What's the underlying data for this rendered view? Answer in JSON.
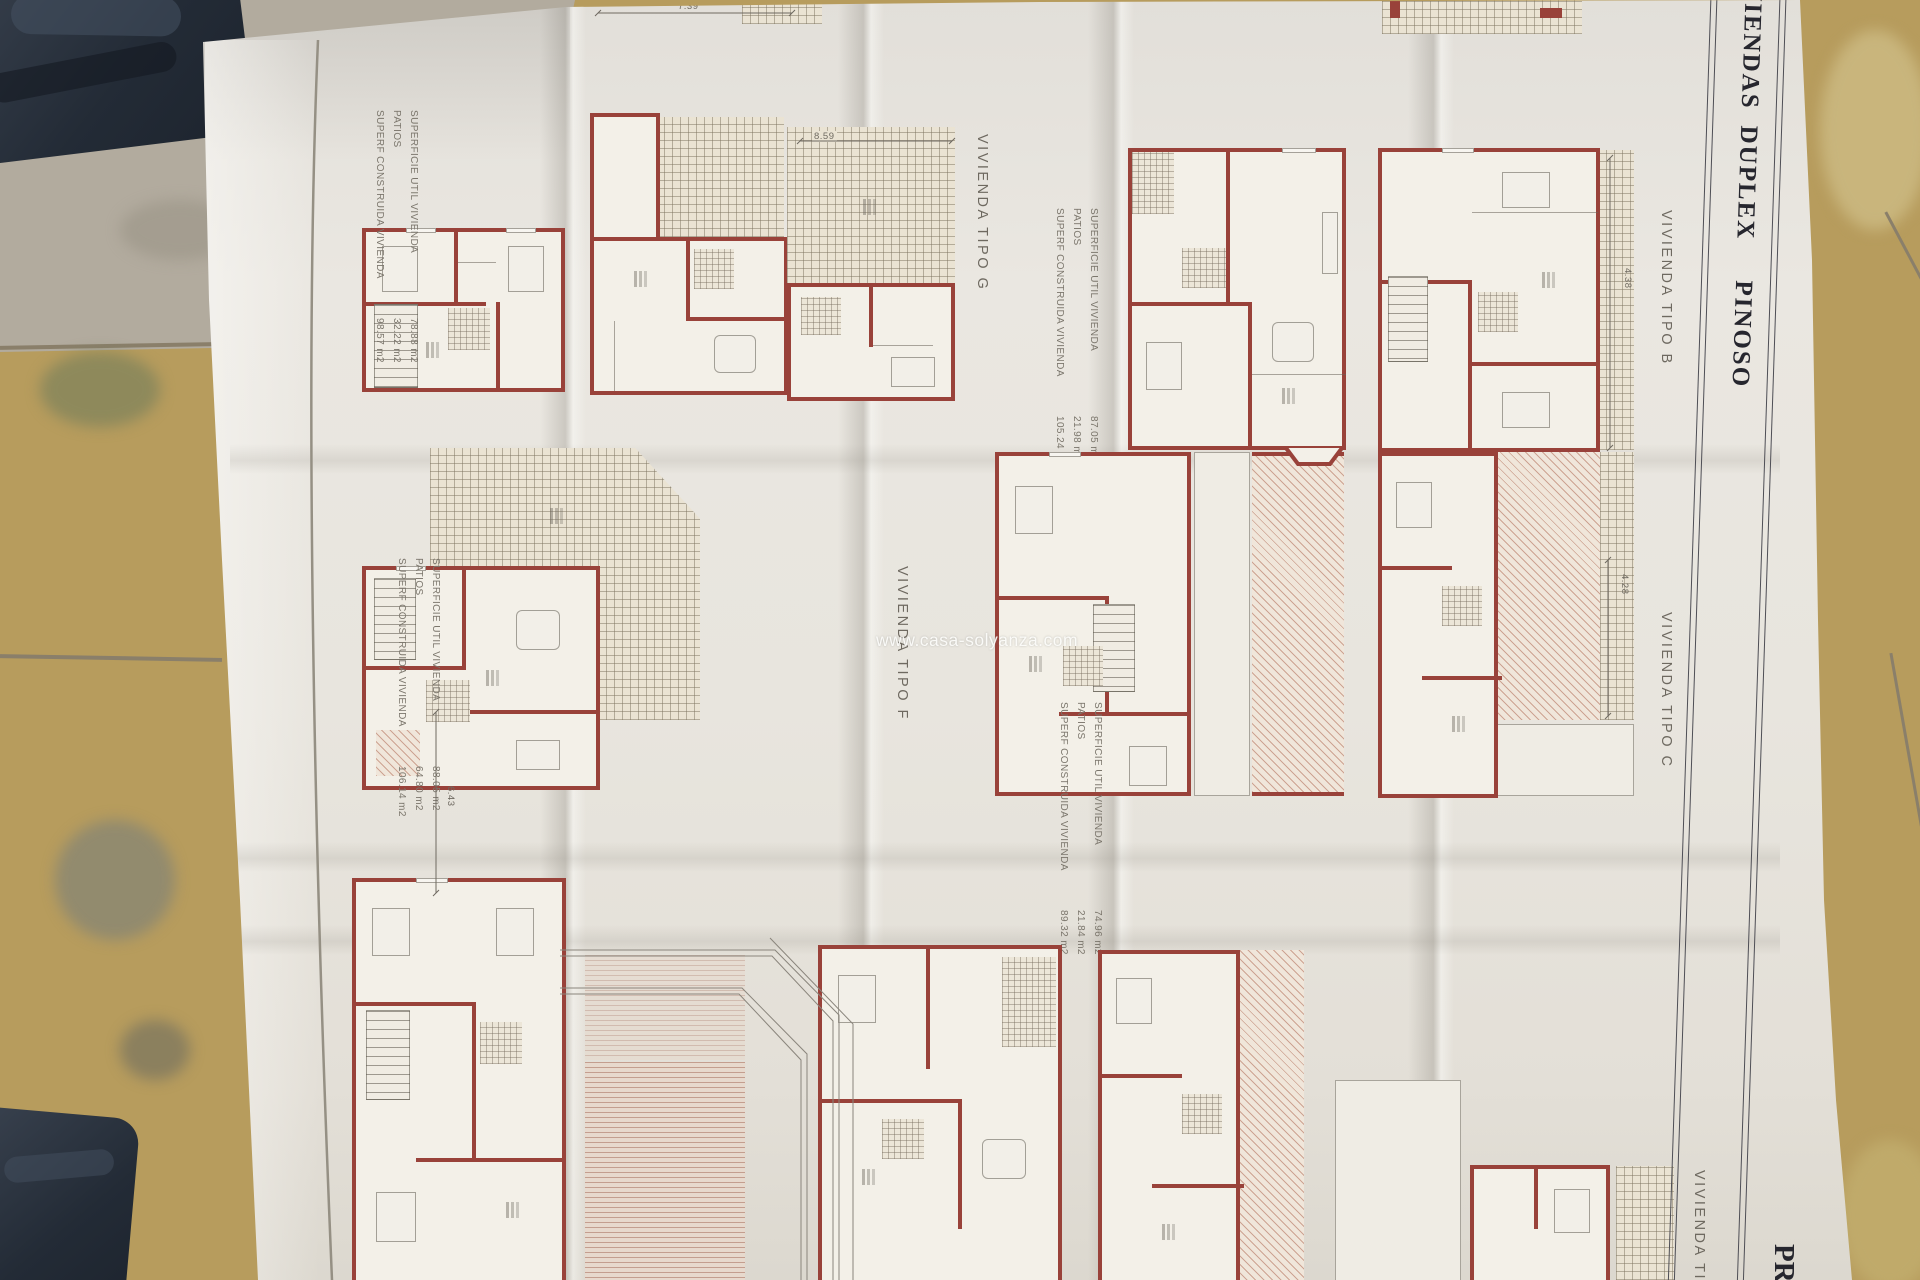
{
  "photo": {
    "watermark": "www.casa-solyanza.com",
    "paper_color": "#e8e5de",
    "wall_color": "#99423a",
    "tile_colors": [
      "#b79c5d",
      "#b2ab9e",
      "#c2a768",
      "#cdbc85"
    ],
    "dark_object_color": "#2a3340"
  },
  "title_band": {
    "word1": "VIVIENDAS",
    "word2": "DUPLEX",
    "word3": "PINOSO",
    "bottom_fragment": "PR"
  },
  "plan_labels": {
    "tipo_g": "VIVIENDA  TIPO  G",
    "tipo_b": "VIVIENDA  TIPO  B",
    "tipo_c": "VIVIENDA  TIPO  C",
    "tipo_f": "VIVIENDA  TIPO  F",
    "tipo_partial": "VIVIENDA  TIPO"
  },
  "area_tables": {
    "labels": [
      "SUPERFICIE UTIL VIVIENDA",
      "PATIOS",
      "SUPERF CONSTRUIDA VIVIENDA"
    ],
    "tipo_g_values": [
      "78.88 m2",
      "32.22 m2",
      "98.57 m2"
    ],
    "tipo_b_values": [
      "87.05 m2",
      "21.98 m2",
      "105.24 m2"
    ],
    "tipo_c_values": [
      "74.96 m2",
      "21.84 m2",
      "89.32 m2"
    ],
    "tipo_f_values": [
      "88.05 m2",
      "64.80 m2",
      "106.14 m2"
    ]
  },
  "dimensions": {
    "top_strip": "7.39",
    "terrace_g": "8.59",
    "terrace_b": "4.38",
    "patio_f": "6.43",
    "terrace_c": "4.28"
  }
}
